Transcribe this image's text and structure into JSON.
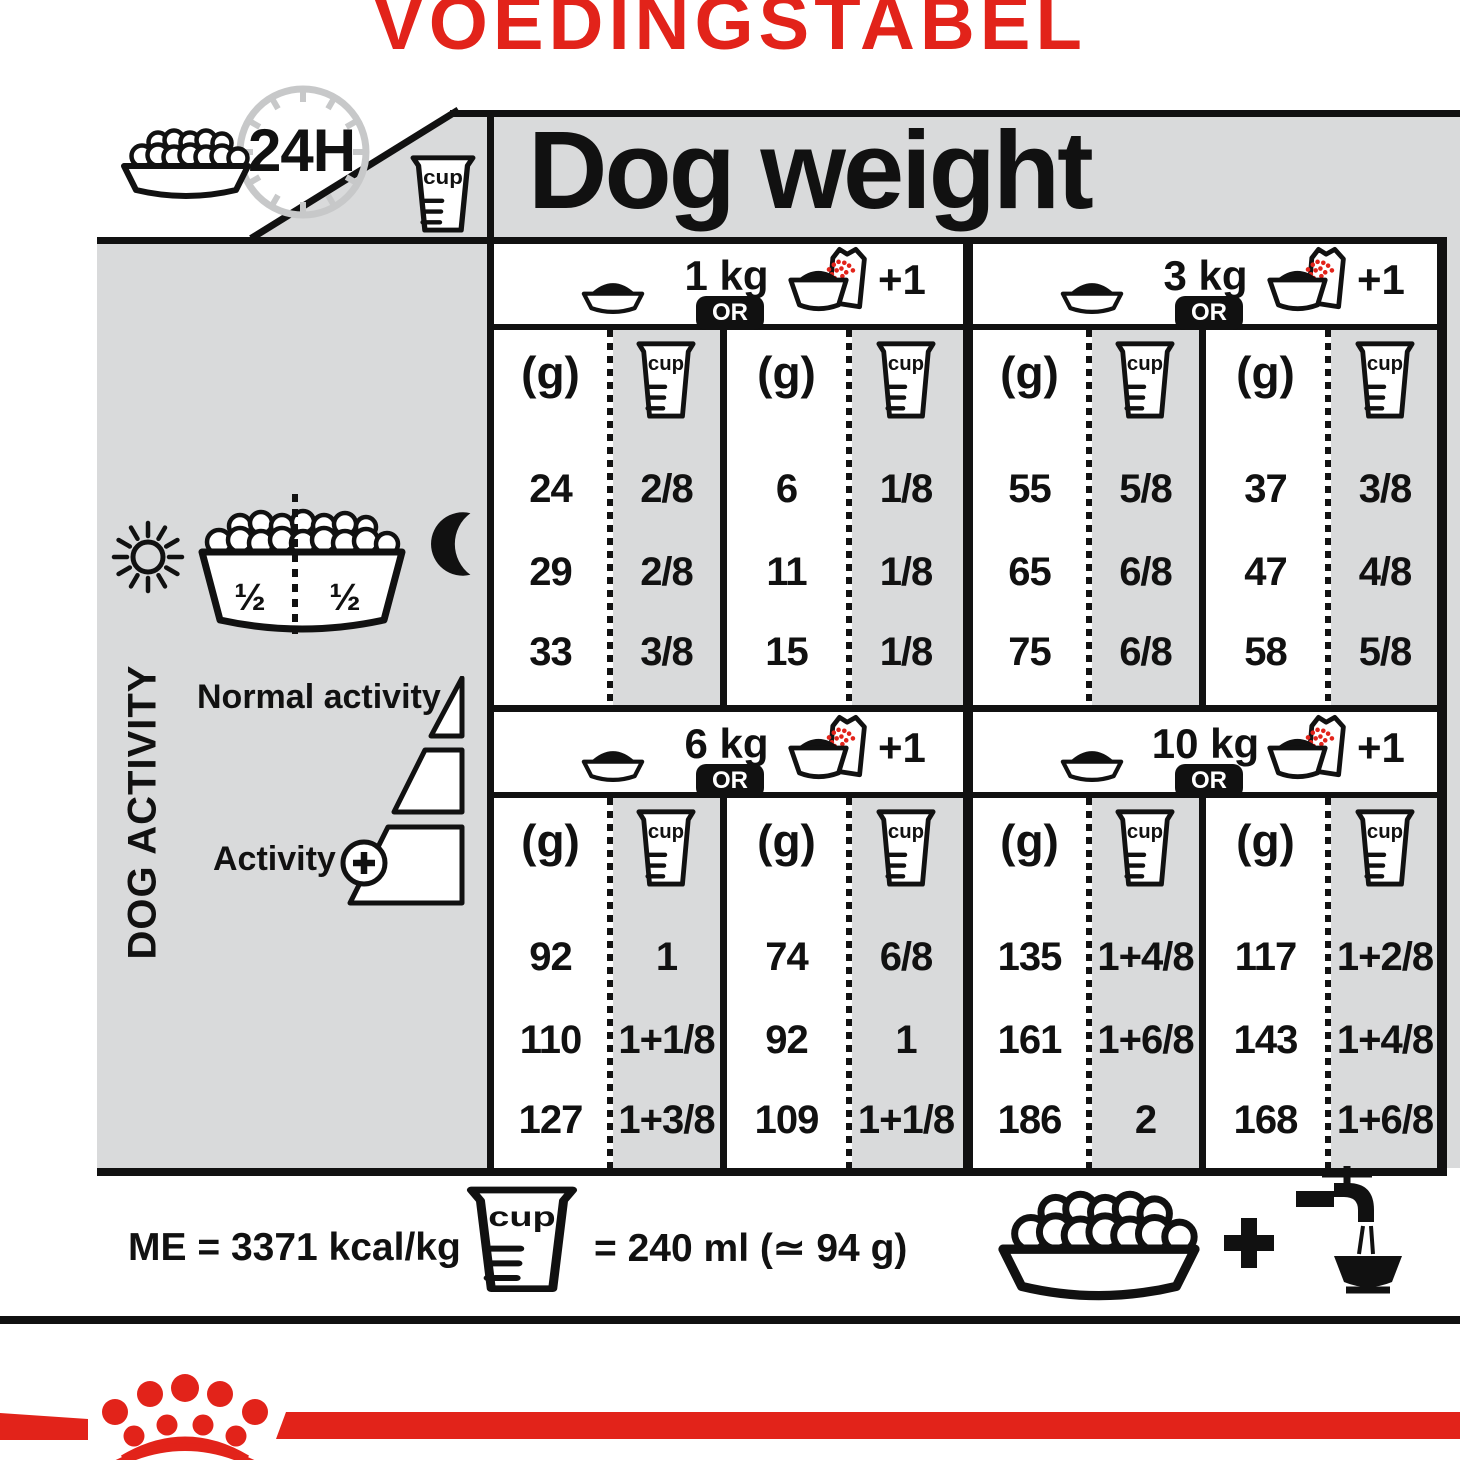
{
  "title": "VOEDINGSTABEL",
  "colors": {
    "red": "#e2231a",
    "gray": "#d9dadb",
    "ink": "#111111"
  },
  "labels": {
    "dog_weight": "Dog weight",
    "hours": "24H",
    "cup": "cup",
    "or": "OR",
    "plus_one": "+1",
    "g": "(g)"
  },
  "left_panel": {
    "dog_activity": "DOG ACTIVITY",
    "half_left": "½",
    "half_right": "½",
    "normal_activity": "Normal activity",
    "activity": "Activity"
  },
  "sections": [
    {
      "weight": "1 kg",
      "rows_dry": [
        {
          "g": "24",
          "cup": "2/8"
        },
        {
          "g": "29",
          "cup": "2/8"
        },
        {
          "g": "33",
          "cup": "3/8"
        }
      ],
      "rows_mix": [
        {
          "g": "6",
          "cup": "1/8"
        },
        {
          "g": "11",
          "cup": "1/8"
        },
        {
          "g": "15",
          "cup": "1/8"
        }
      ]
    },
    {
      "weight": "3 kg",
      "rows_dry": [
        {
          "g": "55",
          "cup": "5/8"
        },
        {
          "g": "65",
          "cup": "6/8"
        },
        {
          "g": "75",
          "cup": "6/8"
        }
      ],
      "rows_mix": [
        {
          "g": "37",
          "cup": "3/8"
        },
        {
          "g": "47",
          "cup": "4/8"
        },
        {
          "g": "58",
          "cup": "5/8"
        }
      ]
    },
    {
      "weight": "6 kg",
      "rows_dry": [
        {
          "g": "92",
          "cup": "1"
        },
        {
          "g": "110",
          "cup": "1+1/8"
        },
        {
          "g": "127",
          "cup": "1+3/8"
        }
      ],
      "rows_mix": [
        {
          "g": "74",
          "cup": "6/8"
        },
        {
          "g": "92",
          "cup": "1"
        },
        {
          "g": "109",
          "cup": "1+1/8"
        }
      ]
    },
    {
      "weight": "10 kg",
      "rows_dry": [
        {
          "g": "135",
          "cup": "1+4/8"
        },
        {
          "g": "161",
          "cup": "1+6/8"
        },
        {
          "g": "186",
          "cup": "2"
        }
      ],
      "rows_mix": [
        {
          "g": "117",
          "cup": "1+2/8"
        },
        {
          "g": "143",
          "cup": "1+4/8"
        },
        {
          "g": "168",
          "cup": "1+6/8"
        }
      ]
    }
  ],
  "footer": {
    "me": "ME = 3371 kcal/kg",
    "cup_equals": "= 240 ml (≃ 94 g)"
  }
}
